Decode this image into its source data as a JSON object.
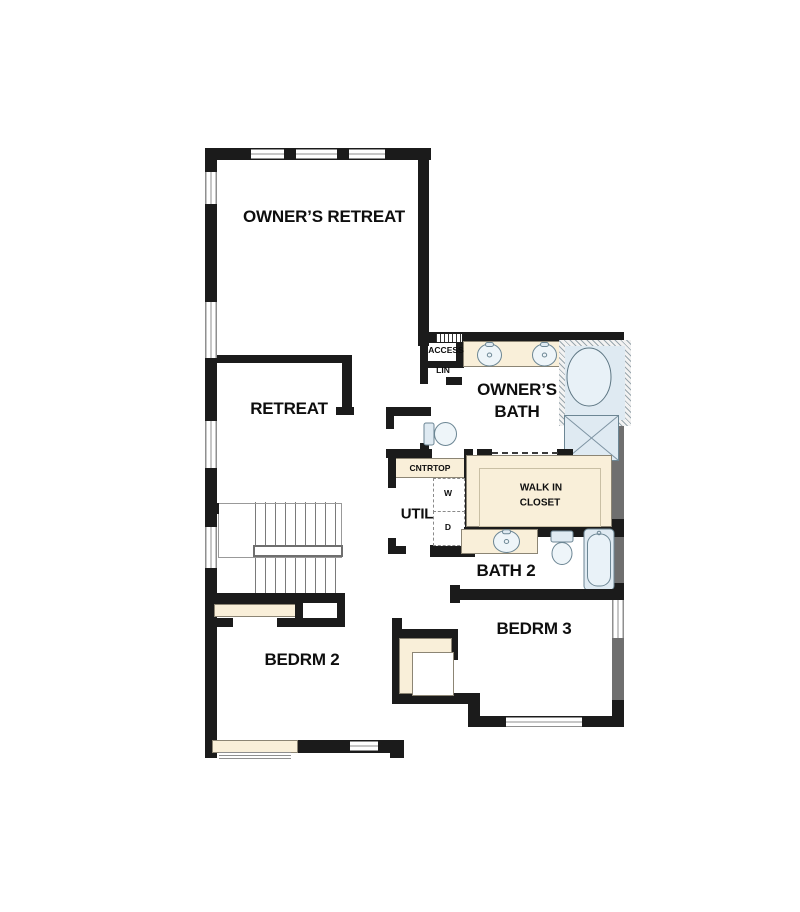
{
  "title": "Second Floor Plan",
  "colors": {
    "wall": "#1b1b1b",
    "wall_gray": "#6f6f6f",
    "counter": "#f9efd9",
    "counter_line": "#8c8574",
    "fixture": "#dfeaf2",
    "fixture_line": "#6c8694",
    "window_line": "#8f8f8f"
  },
  "labels": {
    "owners_retreat": "OWNER’S RETREAT",
    "retreat": "RETREAT",
    "owners_bath_line1": "OWNER’S",
    "owners_bath_line2": "BATH",
    "access": "ACCESS",
    "lin": "LIN",
    "cntrtop": "CNTRTOP",
    "util": "UTIL",
    "washer": "W",
    "dryer": "D",
    "walk_in_line1": "WALK IN",
    "walk_in_line2": "CLOSET",
    "bath2": "BATH 2",
    "bedrm2": "BEDRM 2",
    "bedrm3": "BEDRM 3"
  },
  "fixtures": [
    "double-vanity-sinks",
    "soaking-tub",
    "walk-in-shower",
    "toilet",
    "stacked-washer-dryer",
    "vanity-sink",
    "toilet",
    "bathtub",
    "staircase",
    "attic-access-hatch"
  ]
}
